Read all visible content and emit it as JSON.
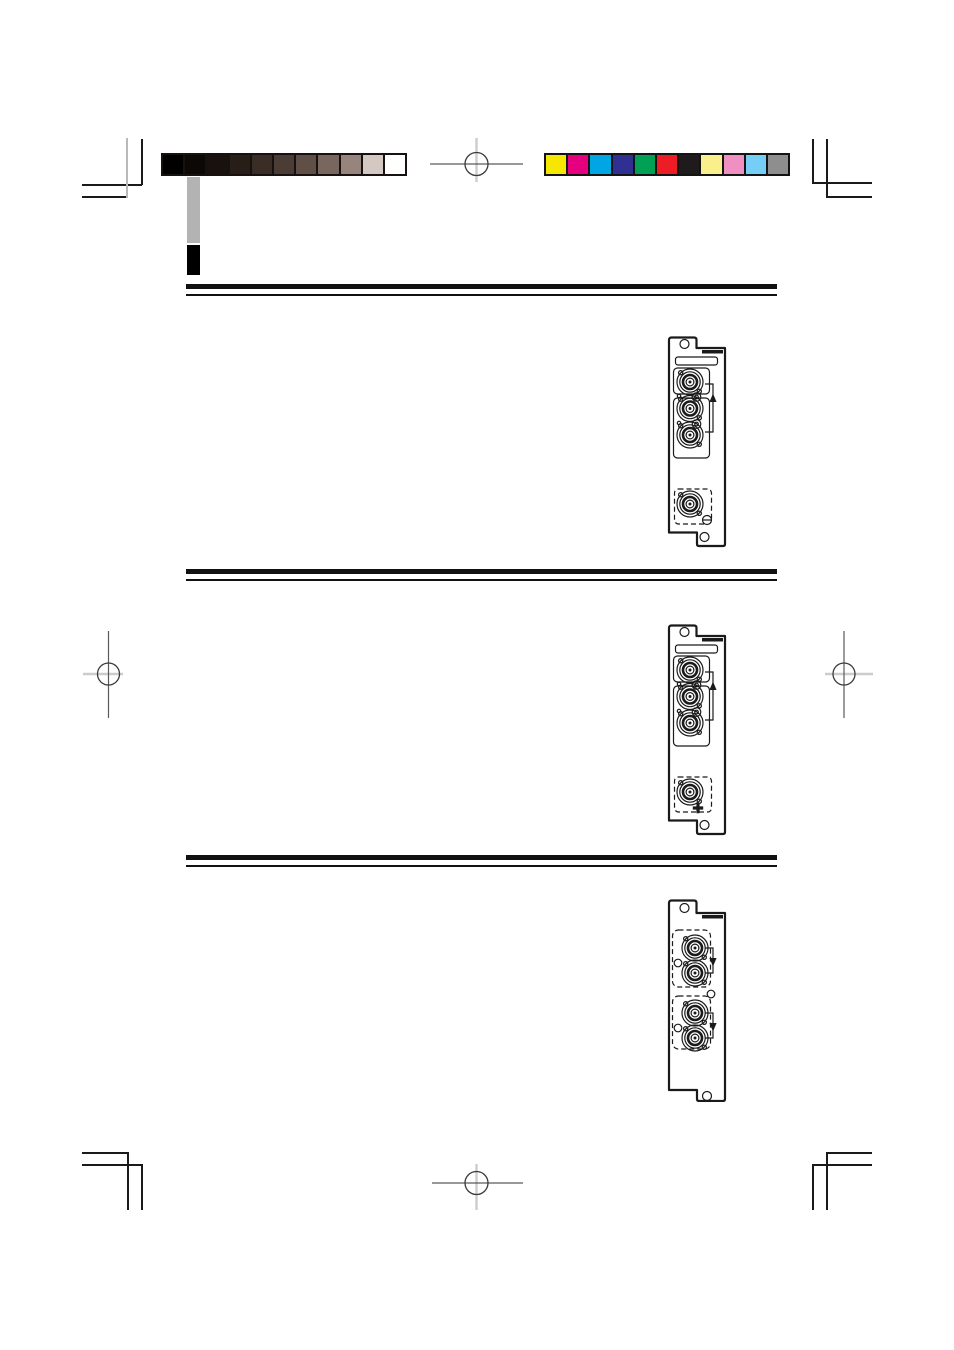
{
  "page": {
    "kind": "print-proof-scan",
    "paper_color": "#ffffff",
    "ink_color": "#1a1a1a"
  },
  "calibration": {
    "grayscale_bar": {
      "swatches": [
        {
          "name": "gray-step-1",
          "hex": "#000000"
        },
        {
          "name": "gray-step-2",
          "hex": "#0c0806"
        },
        {
          "name": "gray-step-3",
          "hex": "#18110d"
        },
        {
          "name": "gray-step-4",
          "hex": "#281e18"
        },
        {
          "name": "gray-step-5",
          "hex": "#392d26"
        },
        {
          "name": "gray-step-6",
          "hex": "#4b3d35"
        },
        {
          "name": "gray-step-7",
          "hex": "#604f47"
        },
        {
          "name": "gray-step-8",
          "hex": "#79675f"
        },
        {
          "name": "gray-step-9",
          "hex": "#97847c"
        },
        {
          "name": "gray-step-10",
          "hex": "#d3c8c2"
        },
        {
          "name": "gray-step-11",
          "hex": "#ffffff"
        }
      ]
    },
    "color_bar": {
      "swatches": [
        {
          "name": "color-yellow",
          "hex": "#f6e700"
        },
        {
          "name": "color-magenta",
          "hex": "#e60080"
        },
        {
          "name": "color-cyan",
          "hex": "#00a5e3"
        },
        {
          "name": "color-blue",
          "hex": "#303093"
        },
        {
          "name": "color-green",
          "hex": "#00a155"
        },
        {
          "name": "color-red",
          "hex": "#ee1c25"
        },
        {
          "name": "color-black",
          "hex": "#1f1b1a"
        },
        {
          "name": "color-light-yellow",
          "hex": "#f9f08c"
        },
        {
          "name": "color-pink",
          "hex": "#f08fc1"
        },
        {
          "name": "color-light-blue",
          "hex": "#74cef5"
        },
        {
          "name": "color-gray",
          "hex": "#8e8e8e"
        }
      ]
    }
  },
  "chapter_tab": {
    "gray_hex": "#b3b3b3",
    "black_hex": "#000000"
  },
  "section_rules": {
    "count": 3,
    "style": "thick-over-thin double rule"
  },
  "printers_marks": {
    "corner_crop_marks": 4,
    "registration_targets": 4
  },
  "connector_panels": [
    {
      "id": "panel-1",
      "bnc_jacks": 4,
      "loop_through_arrow": "up",
      "bottom_fastener": "slotted-screw"
    },
    {
      "id": "panel-2",
      "bnc_jacks": 4,
      "loop_through_arrow": "up",
      "bottom_fastener": "phillips-screw"
    },
    {
      "id": "panel-3",
      "bnc_jacks": 4,
      "loop_through_arrow": "down",
      "bottom_fastener": "none"
    }
  ]
}
